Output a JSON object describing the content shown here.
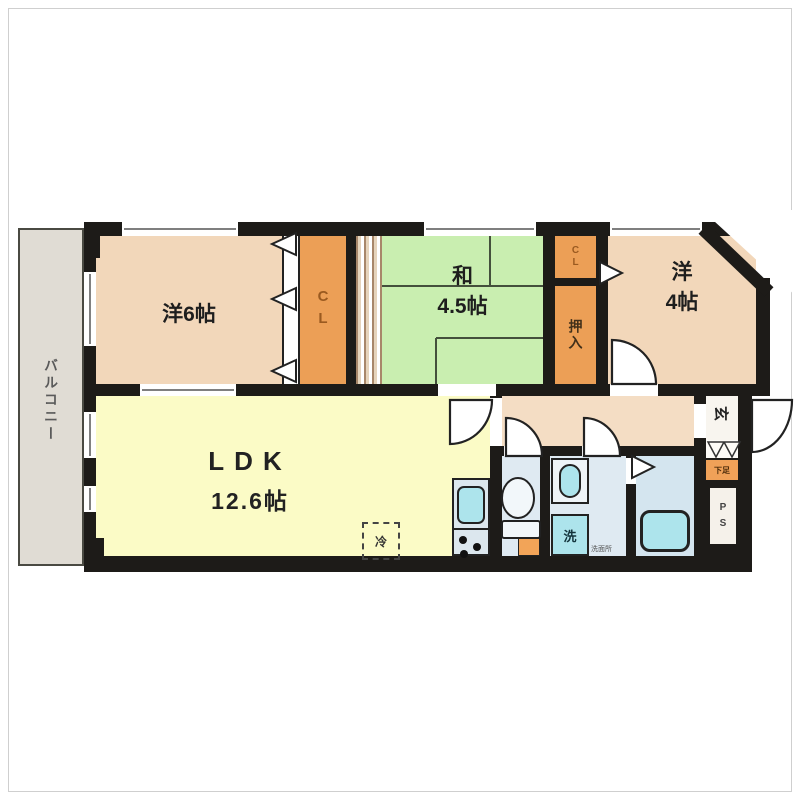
{
  "balcony": {
    "label": "バルコニー"
  },
  "rooms": {
    "western6": {
      "label": "洋6帖"
    },
    "closet_main": {
      "label": "CL"
    },
    "japanese": {
      "label": "和\n4.5帖"
    },
    "closet_small": {
      "label": "CL"
    },
    "oshiire": {
      "label": "押入"
    },
    "western4": {
      "label": "洋\n4帖"
    },
    "ldk": {
      "label": "LDK",
      "size": "12.6帖"
    },
    "entrance": {
      "label": "玄"
    },
    "shoe_cabinet": {
      "label": "下足"
    },
    "pipe_space": {
      "label": "P\nS"
    },
    "washer_pan": {
      "label": "洗"
    },
    "washroom": {
      "note": "洗面所"
    },
    "refrigerator": {
      "label": "冷"
    }
  },
  "colors": {
    "wall": "#1d1b18",
    "western_room": "#f2d7ba",
    "closet_orange": "#ec9f56",
    "japanese_room": "#c9eeb0",
    "ldk_yellow": "#fbfbc6",
    "hallway": "#f4ddc4",
    "balcony": "#e0dcd4",
    "sanitary": "#dfeaf2",
    "bath": "#d4e5ef",
    "fixture_cyan": "#ade4ec",
    "counter": "#dce7ee"
  }
}
